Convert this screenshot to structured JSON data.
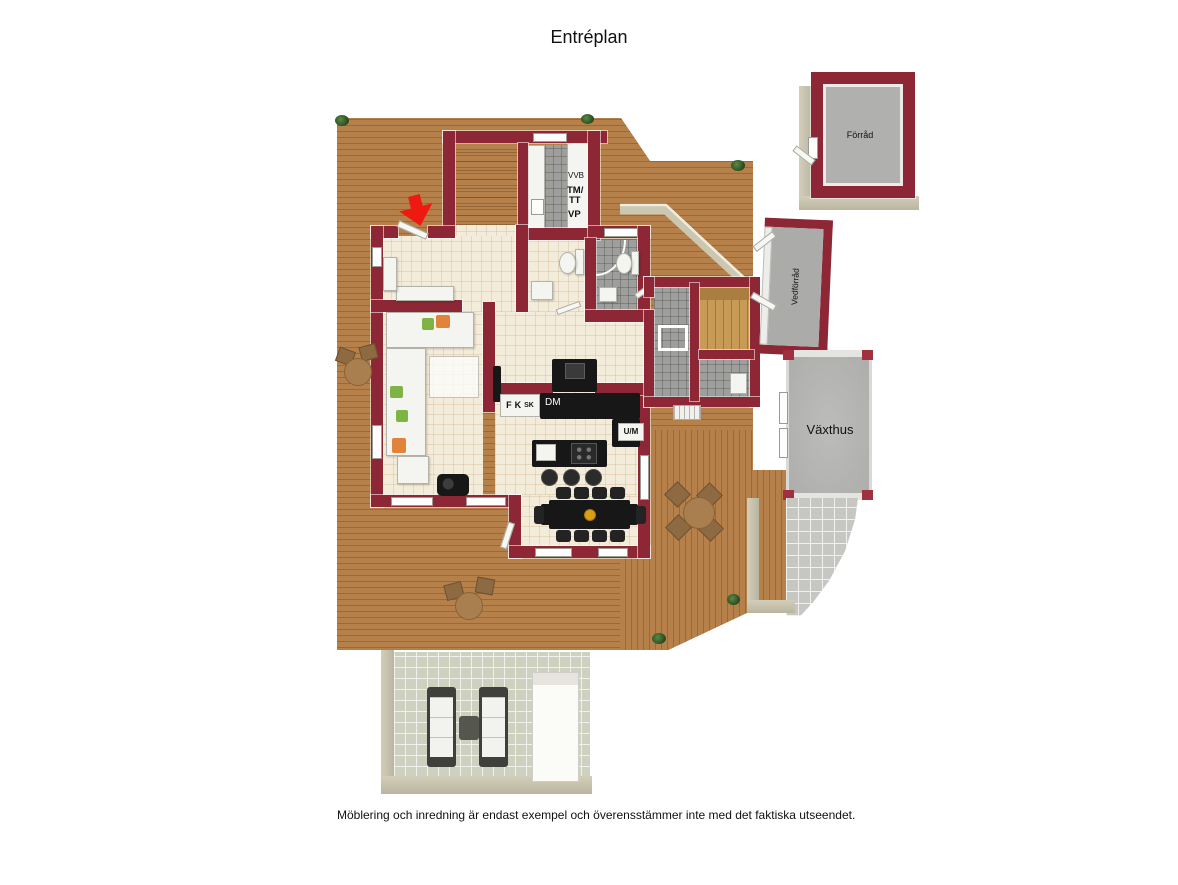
{
  "page": {
    "title": "Entréplan",
    "caption": "Möblering och inredning är endast exempel och överensstämmer inte med det faktiska utseendet."
  },
  "labels": {
    "vvb": "VVB",
    "tm": "TM/",
    "tt": "TT",
    "vp": "VP",
    "f": "F",
    "k": "K",
    "sk": "SK",
    "dm": "DM",
    "um": "U/M"
  },
  "outbuildings": {
    "forrad": "Förråd",
    "vedforrad": "Vedförråd",
    "vaxthus": "Växthus"
  },
  "colors": {
    "wall": "#8e2735",
    "deck_wood": "#b07a42",
    "interior_floor": "#f4ecda",
    "wet_room_tile": "#9e9e9c",
    "sauna_wood": "#c79a55",
    "patio_tile": "#d2d4c6",
    "outbuilding_wall_beige": "#ccc7b0",
    "entrance_arrow": "#ee1a12"
  }
}
